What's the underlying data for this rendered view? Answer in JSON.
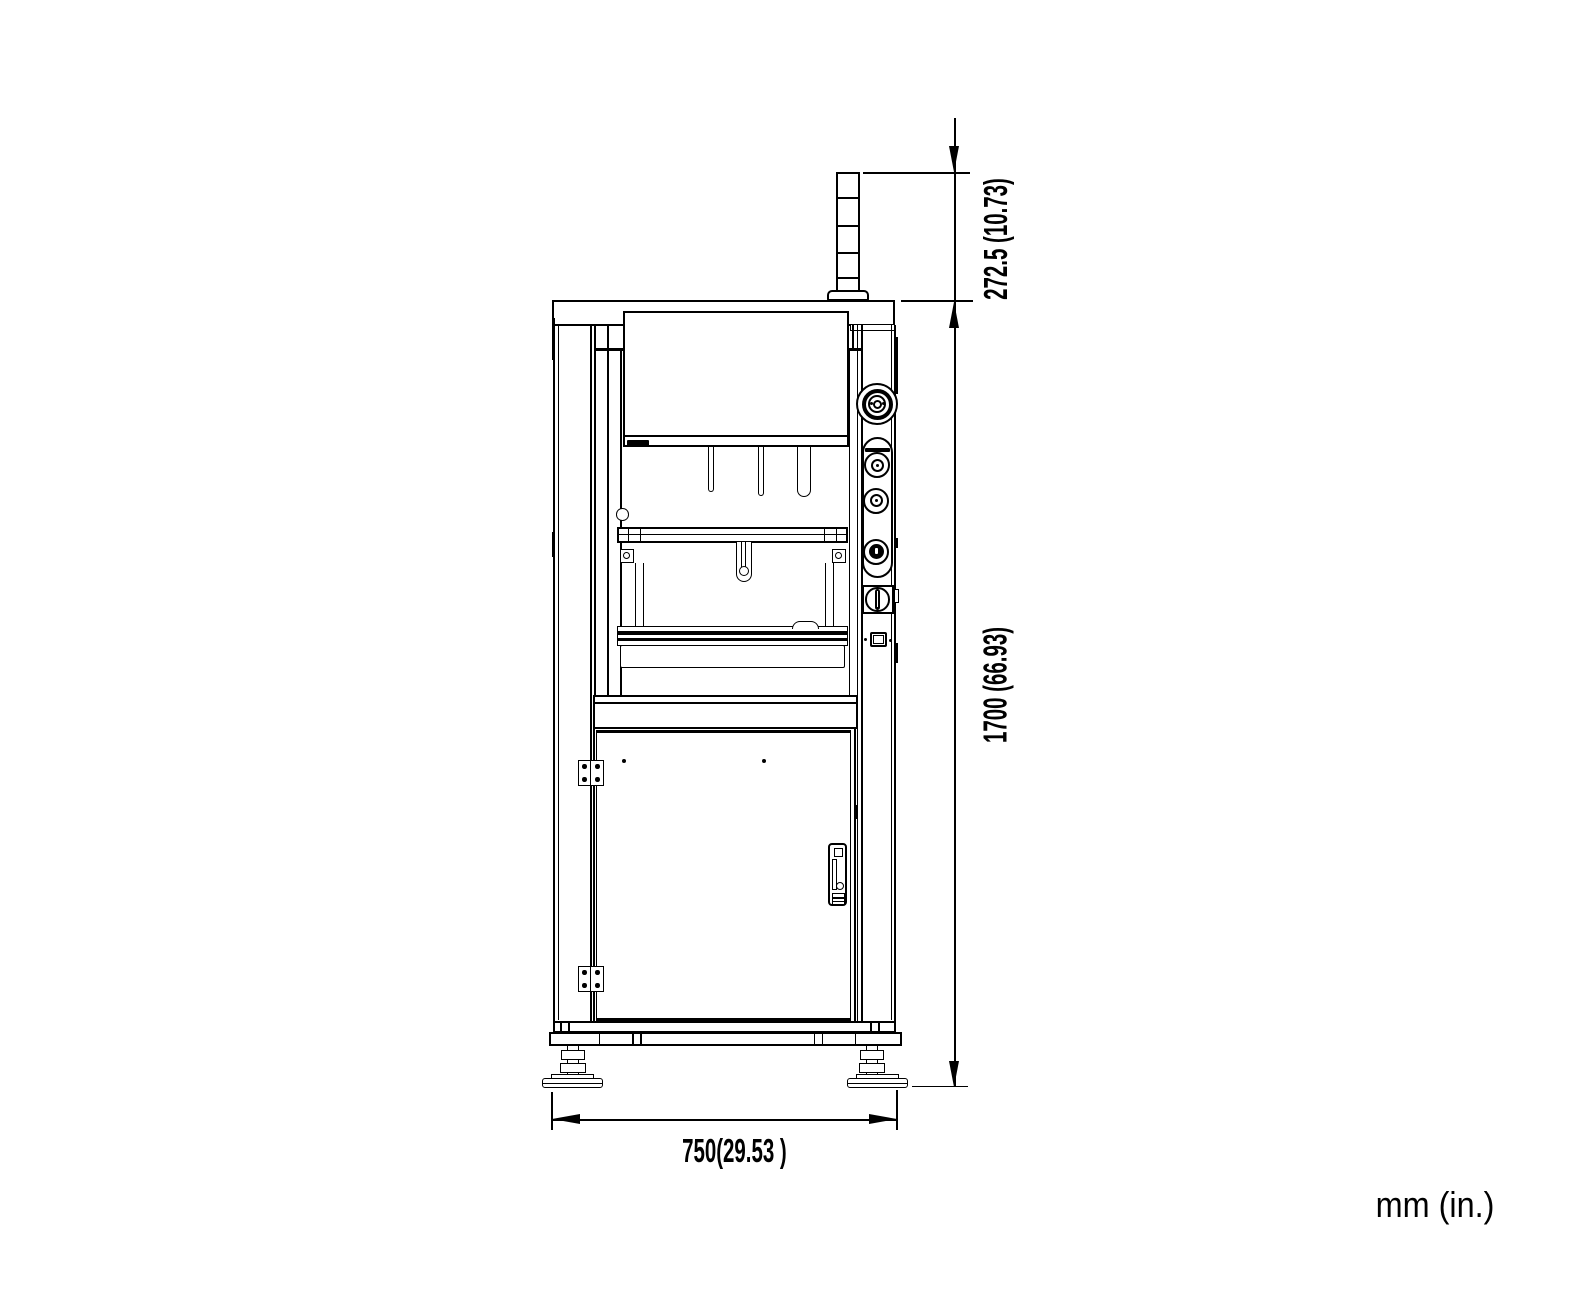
{
  "dimensions": {
    "tower_height_label": "272.5 (10.73)",
    "machine_height_label": "1700 (66.93)",
    "machine_width_label": "750(29.53 )"
  },
  "unit_note": "mm (in.)",
  "line_color": "#000000",
  "background_color": "#ffffff"
}
